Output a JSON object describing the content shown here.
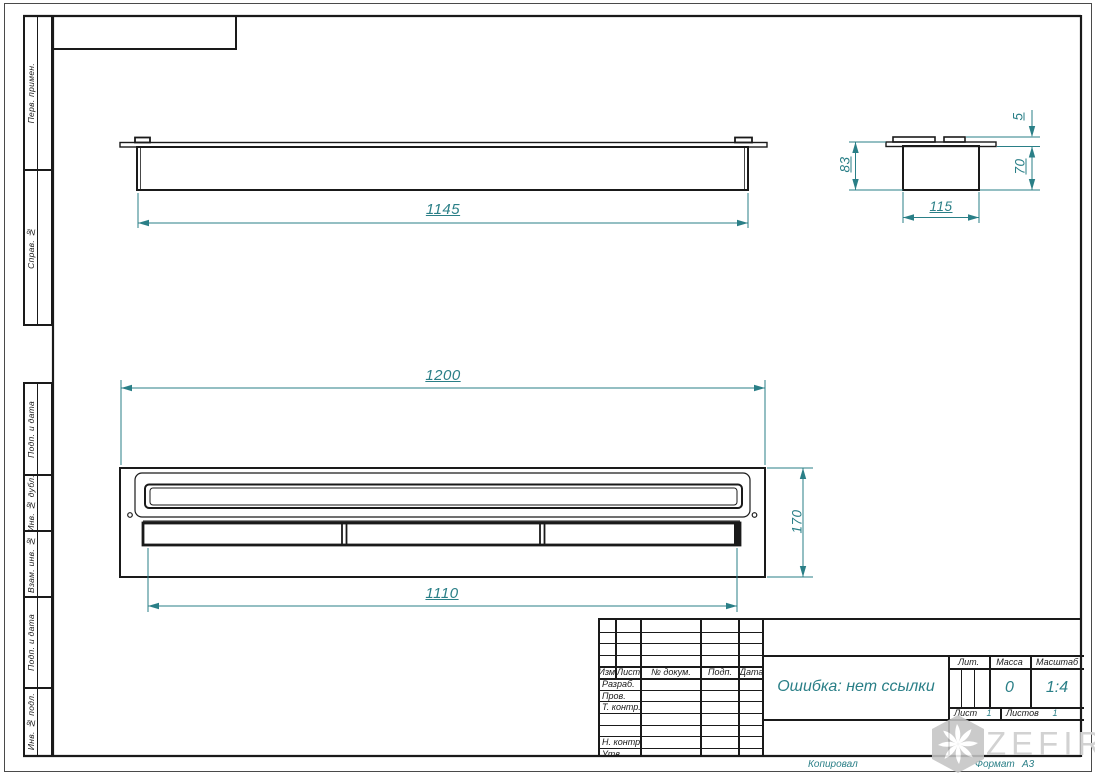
{
  "colors": {
    "accent_teal": "#2a7f87",
    "line_black": "#1a1a1a",
    "watermark_gray": "#d2d2d2"
  },
  "margin_stamps": {
    "top": [
      {
        "label": "Перв. примен."
      },
      {
        "label": "Справ. №"
      }
    ],
    "bottom": [
      {
        "label": "Подп. и дата"
      },
      {
        "label": "Инв. № дубл."
      },
      {
        "label": "Взам. инв. №"
      },
      {
        "label": "Подп. и дата"
      },
      {
        "label": "Инв. № подл."
      }
    ]
  },
  "drawing": {
    "dimensions": {
      "front_width": "1145",
      "plan_width": "1200",
      "plan_depth": "170",
      "lid_width": "1110",
      "side_total_height": "83",
      "side_lip_height": "5",
      "side_body_height": "70",
      "side_body_width": "115"
    }
  },
  "title_block": {
    "revision_header": {
      "izm": "Изм.",
      "list": "Лист",
      "doc": "№ докум.",
      "podp": "Подп.",
      "data": "Дата"
    },
    "role_rows": [
      "Разраб.",
      "Пров.",
      "Т. контр.",
      "Н. контр.",
      "Утв."
    ],
    "doc_name": "Ошибка: нет ссылки",
    "lit_label": "Лит.",
    "mass_label": "Масса",
    "scale_label": "Масштаб",
    "mass_value": "0",
    "scale_value": "1:4",
    "sheet_label": "Лист",
    "sheet_value": "1",
    "sheets_label": "Листов",
    "sheets_value": "1"
  },
  "footer": {
    "copy_label": "Копировал",
    "format_label": "Формат",
    "format_value": "А3"
  },
  "watermark": {
    "brand": "ZEFIRE"
  }
}
